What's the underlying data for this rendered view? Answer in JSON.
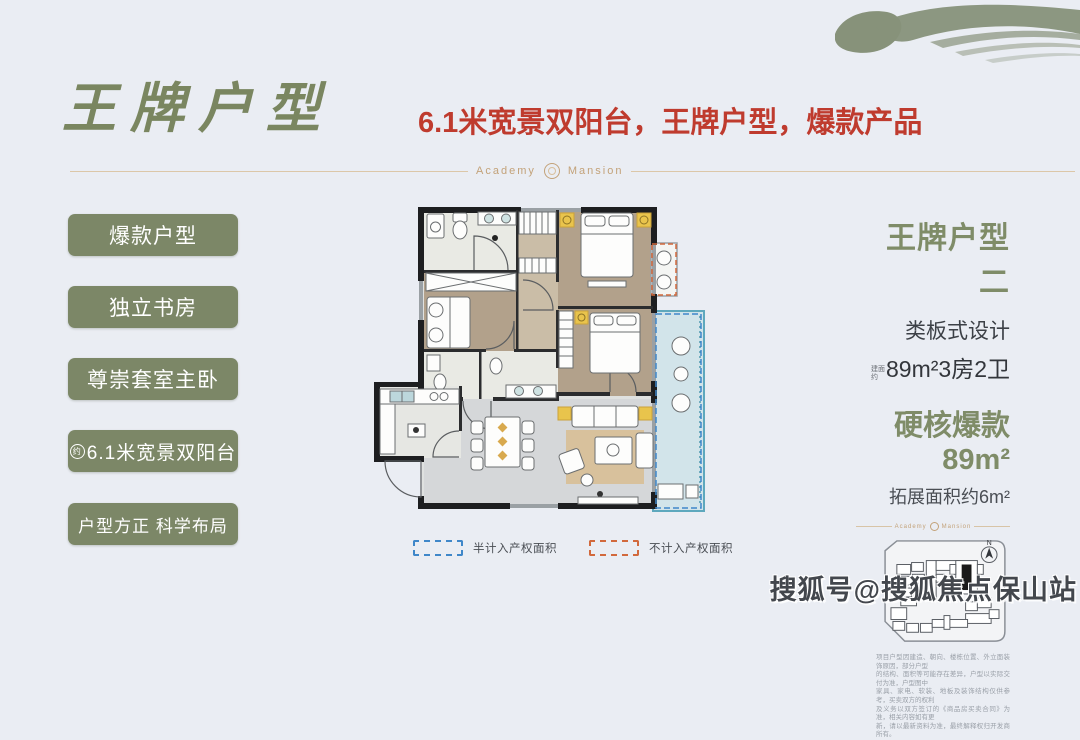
{
  "colors": {
    "background": "#eaedf3",
    "accent_green": "#7c8767",
    "accent_red": "#bf3b2e",
    "brand_gold": "#c3a279",
    "wall_black": "#1d1e20",
    "legend_blue": "#3f87c9",
    "legend_orange": "#d2693c",
    "balcony_teal": "#5ea8bd",
    "furniture_yellow": "#e9c44c"
  },
  "header": {
    "title": "王牌户型",
    "subtitle": "6.1米宽景双阳台，王牌户型，爆款产品"
  },
  "brand": {
    "left": "Academy",
    "right": "Mansion"
  },
  "sidebar": {
    "items": [
      {
        "label": "爆款户型"
      },
      {
        "label": "独立书房"
      },
      {
        "label": "尊崇套室主卧"
      },
      {
        "label": "6.1米宽景双阳台",
        "prefix": "约"
      },
      {
        "label": "户型方正 科学布局"
      }
    ]
  },
  "floorplan": {
    "legend": [
      {
        "label": "半计入产权面积",
        "style": "dashed",
        "color": "#3f87c9"
      },
      {
        "label": "不计入产权面积",
        "style": "dashed",
        "color": "#d2693c"
      }
    ]
  },
  "details": {
    "name": "王牌户型二",
    "design": "类板式设计",
    "area_prefix": "建面约",
    "area_line": "89m²3房2卫",
    "highlight": "硬核爆款89m²",
    "expand": "拓展面积约6m²",
    "compass": "N",
    "disclaimer_lines": [
      "项目户型因建造、朝向、楼栋位置、外立面装饰原因，部分户型",
      "的结构、面积等可能存在差异，户型以实际交付为准，户型图中",
      "家具、家电、软装、地板及装饰结构仅供参考，买卖双方的权利",
      "及义务以双方签订的《商品房买卖合同》为准，相关内容如有更",
      "新，请以最新资料为准，最终解释权归开发商所有。"
    ]
  },
  "watermark": "搜狐号@搜狐焦点保山站"
}
